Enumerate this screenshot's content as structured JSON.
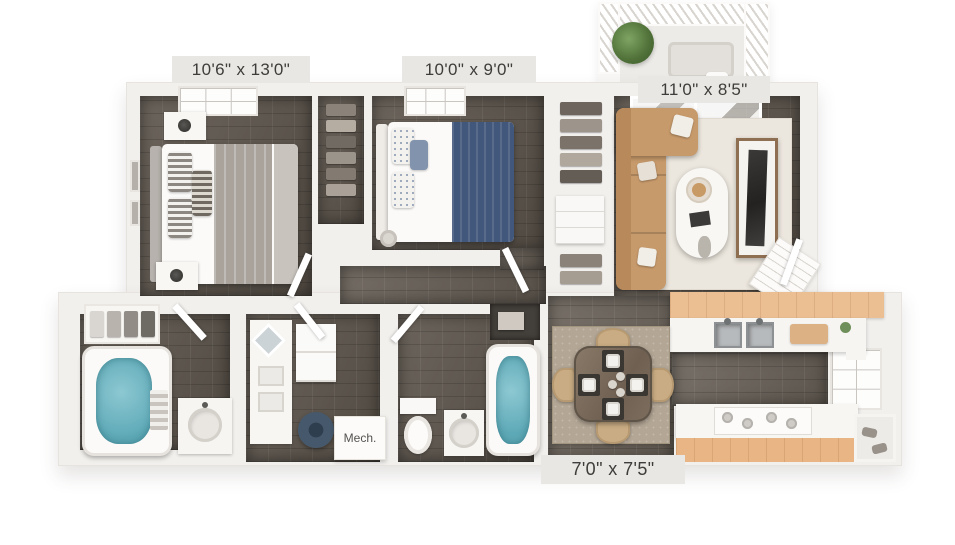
{
  "floor_plan": {
    "rooms": [
      {
        "id": "primary-bedroom",
        "dimensions": "10'6\" x 13'0\""
      },
      {
        "id": "second-bedroom",
        "dimensions": "10'0\" x 9'0\""
      },
      {
        "id": "living-room",
        "dimensions": "11'0\" x 8'5\""
      },
      {
        "id": "dining-area",
        "dimensions": "7'0\" x 7'5\""
      },
      {
        "id": "mechanical-closet",
        "label": "Mech."
      },
      {
        "id": "kitchen"
      },
      {
        "id": "bathroom-1"
      },
      {
        "id": "bathroom-2"
      },
      {
        "id": "laundry-vanity"
      },
      {
        "id": "balcony"
      },
      {
        "id": "closet-1"
      },
      {
        "id": "closet-2"
      }
    ],
    "colors": {
      "background": "#ffffff",
      "wall": "#f2f0ed",
      "wood_floor": "#5e564d",
      "water_teal": "#7cc0cb",
      "blanket_navy": "#41577b",
      "sofa_tan": "#c79a6b",
      "cabinet_wood": "#ecbf93",
      "label_background": "#e9e7e3",
      "label_text": "#3e3d3b"
    }
  }
}
